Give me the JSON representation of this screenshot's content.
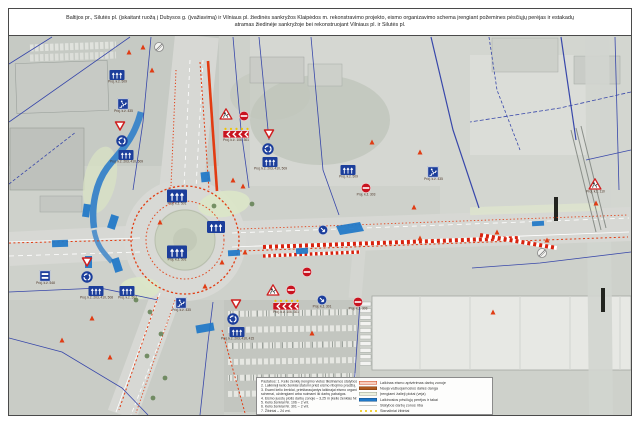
{
  "title": {
    "line1": "Baltijos pr., Šilutės pl. (įskaitant ruožą į Dubysos g. (įvažiavimą) ir Vilniaus pl. žiedinės sankryžos Klaipėdos m. rekonstravimo projekto, eismo organizavimo schema įrengiant požemines pėsčiųjų perėjas ir estakadų",
    "line2": "atramas žiedinėje sankryžoje bei rekonstruojant Vilniaus pl. ir Šilutės pl."
  },
  "colors": {
    "construction_red": "#e23c12",
    "sign_blue": "#1c3e9b",
    "overlay_blue": "#1f78c8",
    "warning_yellow": "#f0c400",
    "parcel_blue": "#3040a8"
  },
  "map": {
    "signs": [
      {
        "type": "endrestrict",
        "x": 159,
        "y": 47
      },
      {
        "type": "marker",
        "x": 129,
        "y": 52
      },
      {
        "type": "marker",
        "x": 143,
        "y": 47
      },
      {
        "type": "lanes",
        "x": 117,
        "y": 75,
        "label": "Proj. k.ž. 509"
      },
      {
        "type": "underpass",
        "x": 123,
        "y": 104,
        "label": "Proj. k.ž. 435"
      },
      {
        "type": "yield",
        "x": 120,
        "y": 126
      },
      {
        "type": "roundabout",
        "x": 122,
        "y": 141
      },
      {
        "type": "lanes",
        "x": 126,
        "y": 155,
        "label": "Proj. k.ž. 203, 410, 509"
      },
      {
        "type": "marker",
        "x": 152,
        "y": 70
      },
      {
        "type": "roadworks",
        "x": 226,
        "y": 114
      },
      {
        "type": "noentry",
        "x": 244,
        "y": 116
      },
      {
        "type": "chevrons",
        "x": 236,
        "y": 133,
        "label": "Proj. k.ž. 106, 301"
      },
      {
        "type": "yield",
        "x": 269,
        "y": 134
      },
      {
        "type": "roundabout",
        "x": 268,
        "y": 149
      },
      {
        "type": "lanes",
        "x": 270,
        "y": 162,
        "label": "Proj. k.ž. 203, 410, 509"
      },
      {
        "type": "lanes",
        "x": 348,
        "y": 170,
        "label": "Proj. k.ž. 509"
      },
      {
        "type": "noentry",
        "x": 366,
        "y": 188,
        "label": "Proj. k.ž. 303"
      },
      {
        "type": "underpass",
        "x": 433,
        "y": 172,
        "label": "Proj. k.ž. 435"
      },
      {
        "type": "roadworks",
        "x": 595,
        "y": 184,
        "label": "Proj. k.ž. 110"
      },
      {
        "type": "endrestrict",
        "x": 542,
        "y": 253
      },
      {
        "type": "twobars",
        "x": 45,
        "y": 276,
        "label": "Proj. k.ž. 548"
      },
      {
        "type": "yield",
        "x": 87,
        "y": 262
      },
      {
        "type": "roundabout",
        "x": 87,
        "y": 277
      },
      {
        "type": "lanes",
        "x": 96,
        "y": 291,
        "label": "Proj. k.ž. 203, 410, 508"
      },
      {
        "type": "lanes",
        "x": 127,
        "y": 291,
        "label": "Proj. k.ž. 507"
      },
      {
        "type": "lanes",
        "x": 177,
        "y": 196,
        "w": 20,
        "label": "Proj. k.ž. 501"
      },
      {
        "type": "lanes",
        "x": 216,
        "y": 227,
        "w": 18
      },
      {
        "type": "lanes",
        "x": 177,
        "y": 252,
        "w": 20,
        "label": "Proj. k.ž. 501"
      },
      {
        "type": "underpass",
        "x": 181,
        "y": 303,
        "label": "Proj. k.ž. 435"
      },
      {
        "type": "yield",
        "x": 236,
        "y": 304
      },
      {
        "type": "roundabout",
        "x": 233,
        "y": 319
      },
      {
        "type": "lanes",
        "x": 237,
        "y": 332,
        "label": "Proj. k.ž. 203, 410, 415"
      },
      {
        "type": "roadworks",
        "x": 273,
        "y": 290
      },
      {
        "type": "noentry",
        "x": 291,
        "y": 290
      },
      {
        "type": "chevrons",
        "x": 286,
        "y": 305,
        "label": "Proj. k.ž. 106, 301"
      },
      {
        "type": "keepright",
        "x": 322,
        "y": 300,
        "label": "Proj. k.ž. 301"
      },
      {
        "type": "noentry",
        "x": 358,
        "y": 302,
        "label": "Proj. k.ž. 303"
      },
      {
        "type": "keepright",
        "x": 323,
        "y": 230
      },
      {
        "type": "noentry",
        "x": 307,
        "y": 272
      },
      {
        "type": "marker",
        "x": 233,
        "y": 180
      },
      {
        "type": "marker",
        "x": 243,
        "y": 186
      },
      {
        "type": "marker",
        "x": 245,
        "y": 252
      },
      {
        "type": "marker",
        "x": 222,
        "y": 262
      },
      {
        "type": "marker",
        "x": 160,
        "y": 222
      },
      {
        "type": "marker",
        "x": 205,
        "y": 286
      },
      {
        "type": "marker",
        "x": 312,
        "y": 333
      },
      {
        "type": "marker",
        "x": 372,
        "y": 142
      },
      {
        "type": "marker",
        "x": 420,
        "y": 152
      },
      {
        "type": "marker",
        "x": 414,
        "y": 207
      },
      {
        "type": "marker",
        "x": 420,
        "y": 238
      },
      {
        "type": "marker",
        "x": 497,
        "y": 232
      },
      {
        "type": "marker",
        "x": 547,
        "y": 240
      },
      {
        "type": "marker",
        "x": 596,
        "y": 203
      },
      {
        "type": "marker",
        "x": 493,
        "y": 312
      },
      {
        "type": "marker",
        "x": 92,
        "y": 318
      },
      {
        "type": "marker",
        "x": 62,
        "y": 340
      },
      {
        "type": "marker",
        "x": 110,
        "y": 357
      }
    ]
  },
  "panel": {
    "notes": {
      "lines": [
        "Pastabos: 1. Kelio ženklų įrengimo vietos tikslinamos statybos metu.",
        "2. Laikinieji kelio ženklai statomi prieš eismo ribojimo pradžią.",
        "3. Esami kelio ženklai, prieštaraujantys laikinajai eismo organizavimo",
        "schemai, uždengiami arba nuimami iki darbų pabaigos.",
        "4. Eismo juostų plotis darbų zonoje – 3,25 m (kelio ženklas Nr. 538).",
        "5. Kelio ženklai Nr. 106 – 2 vnt.",
        "6. Kelio ženklai Nr. 301 – 2 vnt.",
        "7. Žibintai – 24 vnt."
      ]
    },
    "legend": {
      "items": [
        {
          "swatch": "outline",
          "label": "Laikinas eismo aptvėrimas darbų zonoje"
        },
        {
          "swatch": "brown",
          "label": "Nauja važiuojamosios dalies danga"
        },
        {
          "swatch": "pale",
          "label": "Įrengiami žalieji plotai (veja)"
        },
        {
          "swatch": "blue",
          "label": "Laikinosios pėsčiųjų perėjos ir takai"
        },
        {
          "swatch": "line",
          "label": "Statybos darbų zonos riba"
        },
        {
          "swatch": "dots",
          "label": "Signaliniai žibintai"
        }
      ]
    }
  }
}
